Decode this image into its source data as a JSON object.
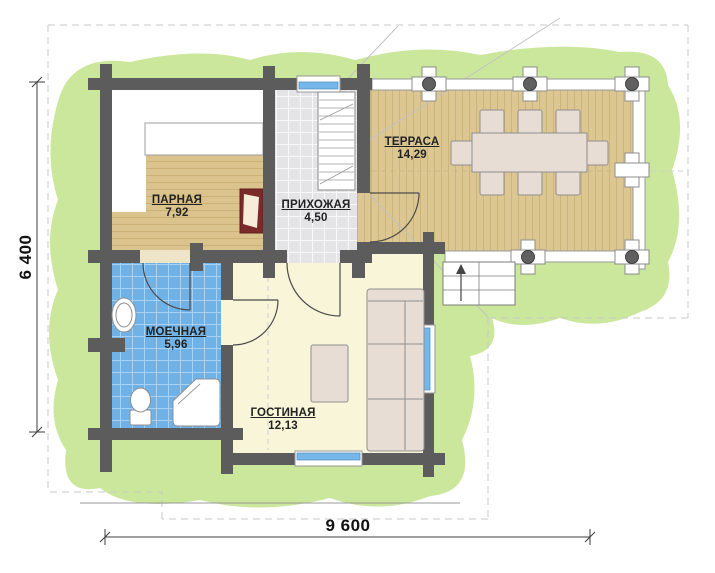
{
  "plan": {
    "rooms": [
      {
        "name": "ПАРНАЯ",
        "area": "7,92"
      },
      {
        "name": "ПРИХОЖАЯ",
        "area": "4,50"
      },
      {
        "name": "ТЕРРАСА",
        "area": "14,29"
      },
      {
        "name": "МОЕЧНАЯ",
        "area": "5,96"
      },
      {
        "name": "ГОСТИНАЯ",
        "area": "12,13"
      }
    ],
    "dimensions": {
      "bottom": "9 600",
      "left": "6 400"
    },
    "colors": {
      "wall": "#5c5c5c",
      "wood_deck": "#dcc792",
      "wood_floor": "#dac38c",
      "tile_gray": "#e4e4e7",
      "tile_blue": "#6fb2e8",
      "living_floor": "#f9f5d8",
      "lawn": "#cbe79b",
      "window": "#74b7e8",
      "furniture": "#e8ddd5",
      "heater": "#7b2929",
      "rail": "#ffffff"
    }
  }
}
